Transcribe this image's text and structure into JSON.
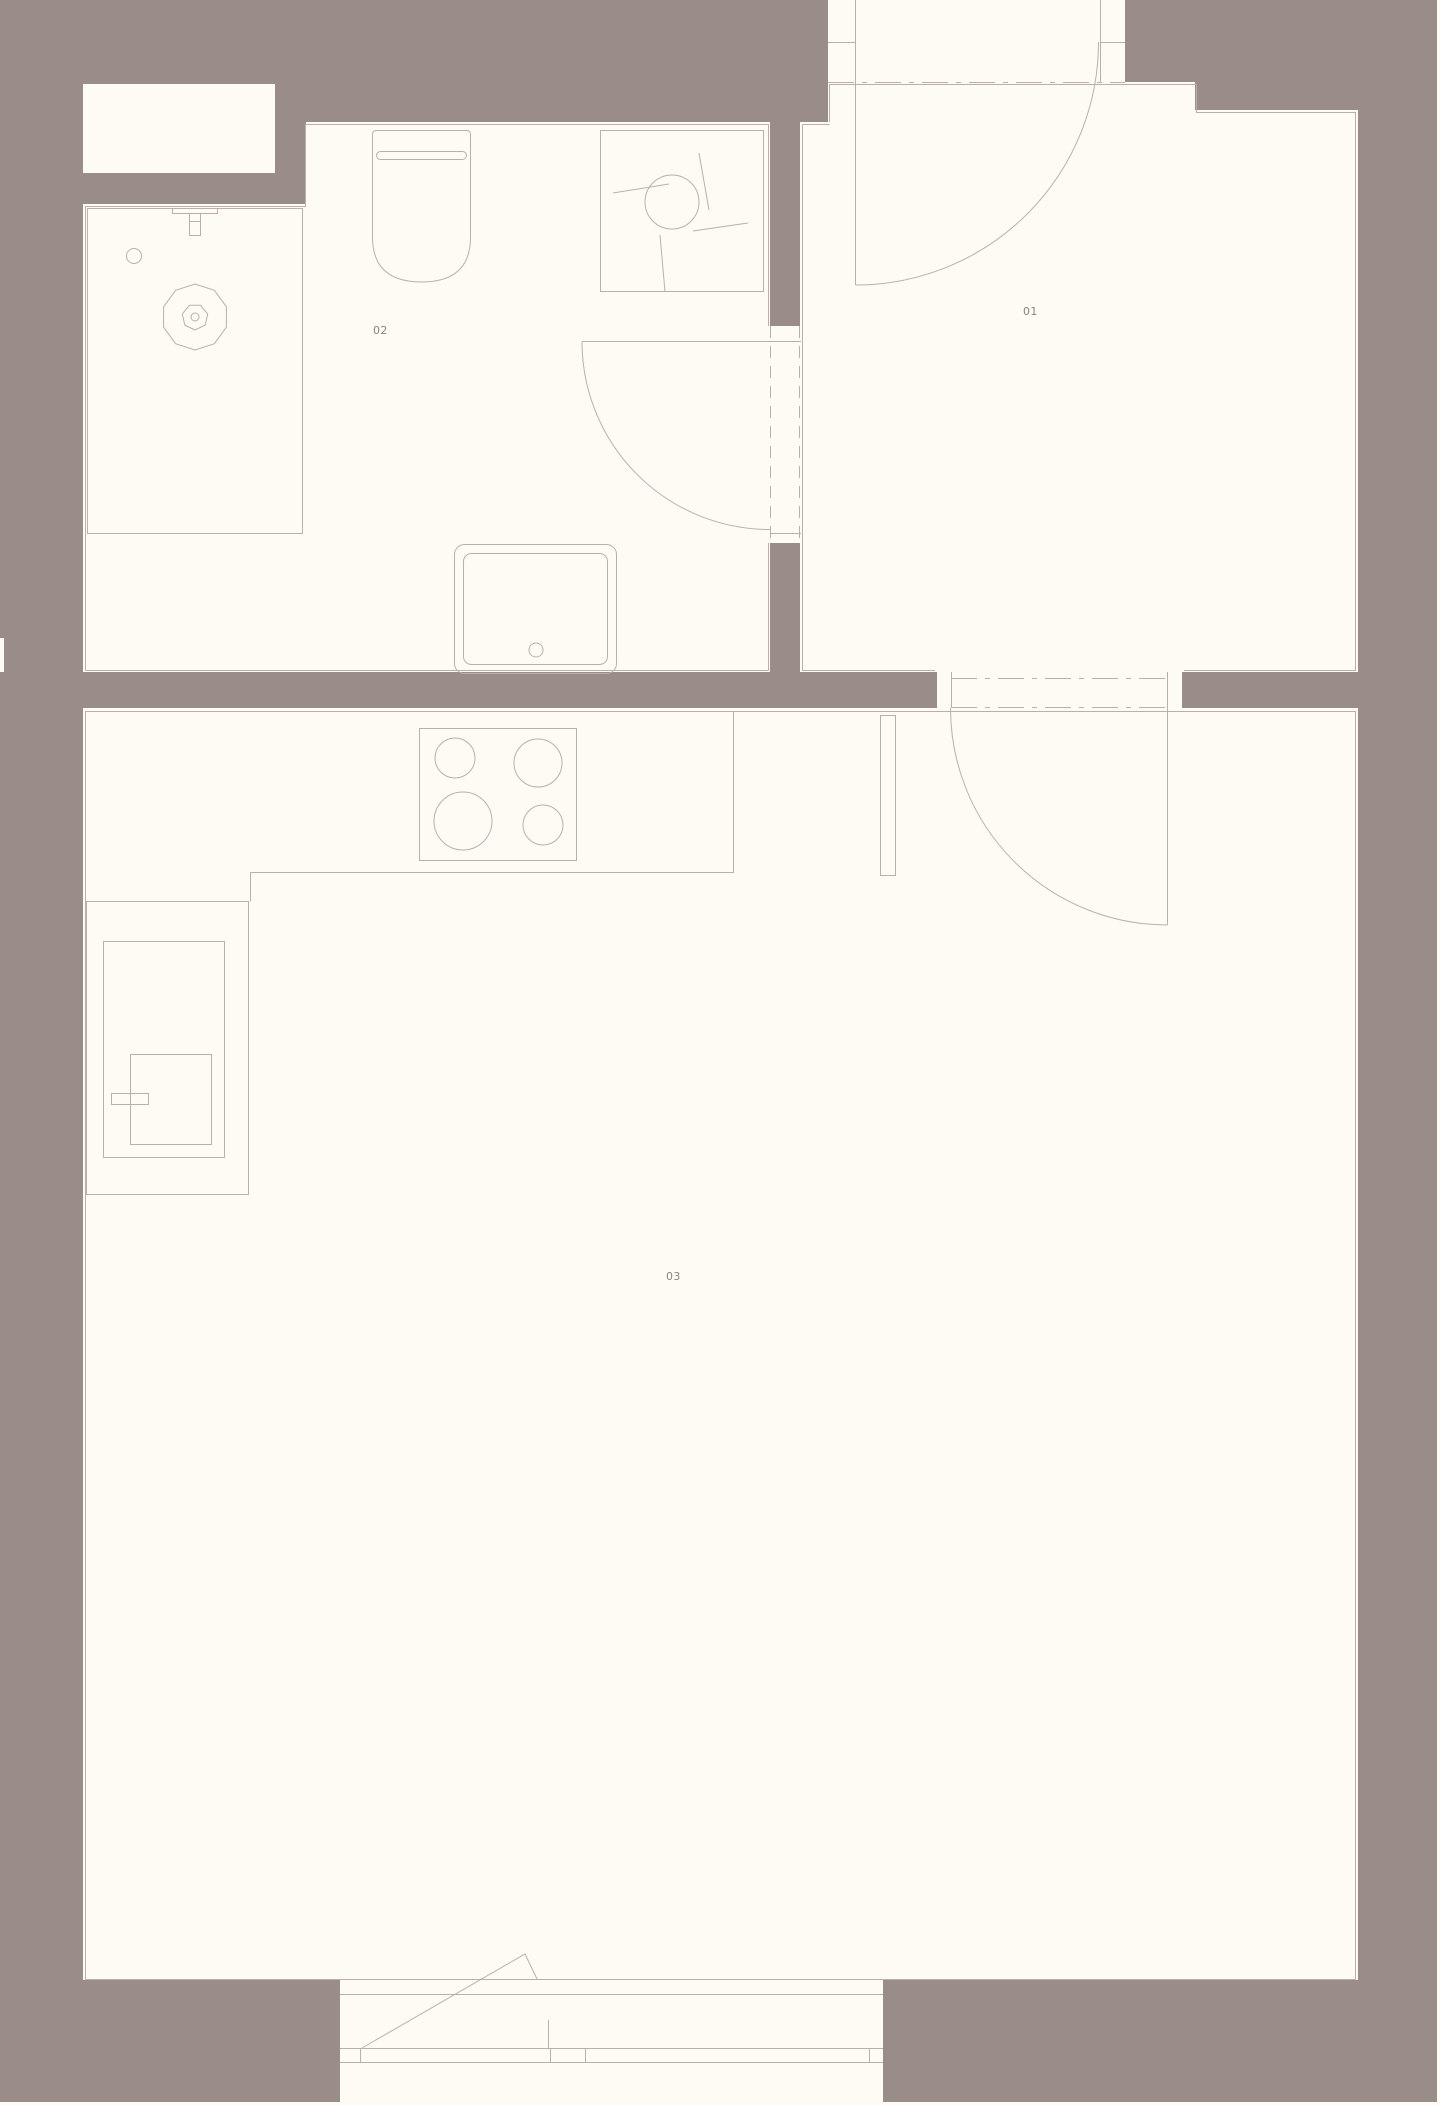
{
  "plan": {
    "title": "apartment-floor-plan",
    "width_px": 1440,
    "height_px": 2105,
    "rooms": [
      {
        "number": "01"
      },
      {
        "number": "02"
      },
      {
        "number": "03"
      }
    ]
  },
  "colors": {
    "wall": "#9a8c89",
    "floor": "#fdfbf4",
    "line": "#bcafa9",
    "label": "#8e807d"
  },
  "fixtures": [
    "shower-tray",
    "shower-head",
    "shower-valve",
    "shower-drain",
    "toilet",
    "washing-machine",
    "sink",
    "kitchen-hob",
    "kitchen-counter",
    "tall-cabinet",
    "boiler",
    "entrance-door",
    "bathroom-door",
    "room-connecting-door",
    "terrace-door",
    "wall-niche",
    "wall-column"
  ]
}
